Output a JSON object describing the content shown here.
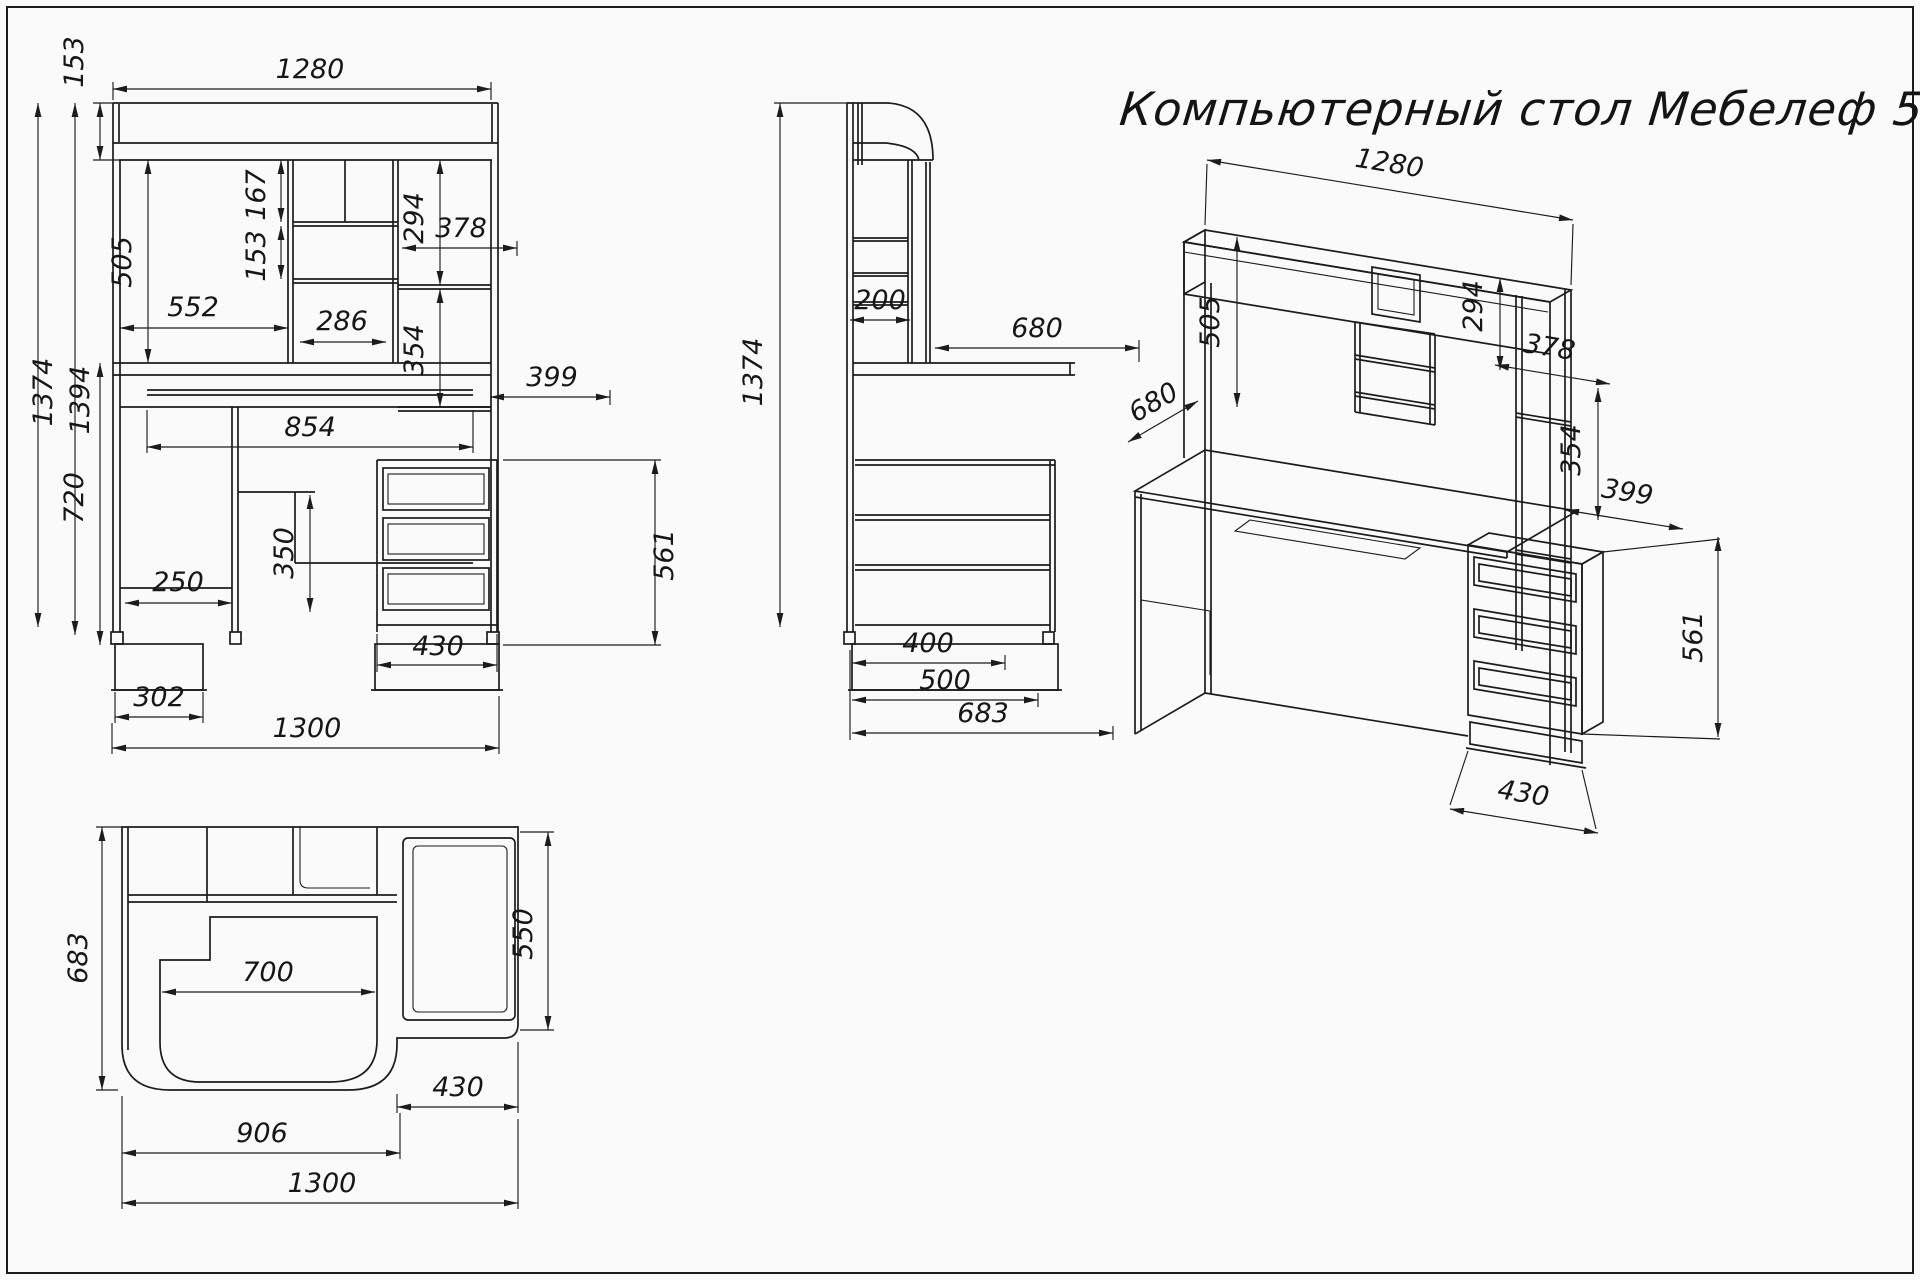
{
  "title": "Компьютерный стол Мебелеф 5",
  "views": {
    "front": {
      "dims": {
        "w1280": "1280",
        "h153": "153",
        "h1374": "1374",
        "h1394": "1394",
        "h505": "505",
        "h167": "167",
        "h153m": "153",
        "w552": "552",
        "w286": "286",
        "h294": "294",
        "w378": "378",
        "h354": "354",
        "w399": "399",
        "w854": "854",
        "h720": "720",
        "h350": "350",
        "w250": "250",
        "w302": "302",
        "w1300": "1300",
        "w430": "430",
        "h561": "561"
      }
    },
    "side": {
      "dims": {
        "h1374": "1374",
        "d200": "200",
        "d680": "680",
        "d400": "400",
        "d500": "500",
        "d683": "683"
      }
    },
    "iso": {
      "dims": {
        "w1280": "1280",
        "h505": "505",
        "h294": "294",
        "w378": "378",
        "h354": "354",
        "w399": "399",
        "d680": "680",
        "h561": "561",
        "w430": "430"
      }
    },
    "top": {
      "dims": {
        "d683": "683",
        "w700": "700",
        "d550": "550",
        "w430": "430",
        "w906": "906",
        "w1300": "1300"
      }
    }
  }
}
